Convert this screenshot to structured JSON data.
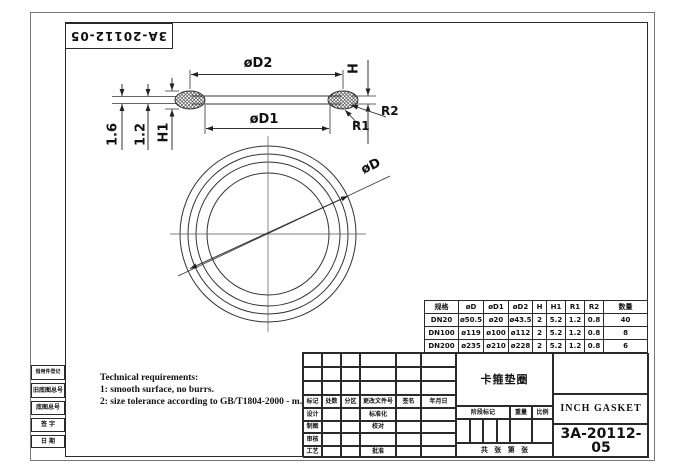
{
  "drawing": {
    "part_number_top": "3A-20112-05",
    "title_cn": "卡箍垫圈",
    "title_en": "INCH GASKET",
    "part_number": "3A-20112-05"
  },
  "labels": {
    "d2": "øD2",
    "d1": "øD1",
    "d": "øD",
    "h": "H",
    "h1": "H1",
    "r1": "R1",
    "r2": "R2",
    "t1": "1.6",
    "t2": "1.2"
  },
  "tech_req": {
    "title": "Technical requirements:",
    "line1": "1: smooth surface, no burrs.",
    "line2": "2: size tolerance according to GB/T1804-2000 - m."
  },
  "spec_table": {
    "headers": [
      "规格",
      "øD",
      "øD1",
      "øD2",
      "H",
      "H1",
      "R1",
      "R2",
      "数量"
    ],
    "rows": [
      [
        "DN20",
        "ø50.5",
        "ø20",
        "ø43.5",
        "2",
        "5.2",
        "1.2",
        "0.8",
        "40"
      ],
      [
        "DN100",
        "ø119",
        "ø100",
        "ø112",
        "2",
        "5.2",
        "1.2",
        "0.8",
        "8"
      ],
      [
        "DN200",
        "ø235",
        "ø210",
        "ø228",
        "2",
        "5.2",
        "1.2",
        "0.8",
        "6"
      ]
    ]
  },
  "title_block": {
    "rev_headers": [
      "标记",
      "处数",
      "分区",
      "更改文件号",
      "签名",
      "年月日"
    ],
    "roles_left": [
      "设计",
      "制图",
      "审核",
      "工艺"
    ],
    "roles_mid": [
      "标准化",
      "校对",
      "批准"
    ],
    "stage": "阶段标记",
    "weight": "重量",
    "scale": "比例",
    "sheet_info": "共  张  第  张"
  },
  "margin": {
    "labels": [
      "借用件登记",
      "旧底图总号",
      "底图总号",
      "签 字",
      "日 期"
    ]
  }
}
